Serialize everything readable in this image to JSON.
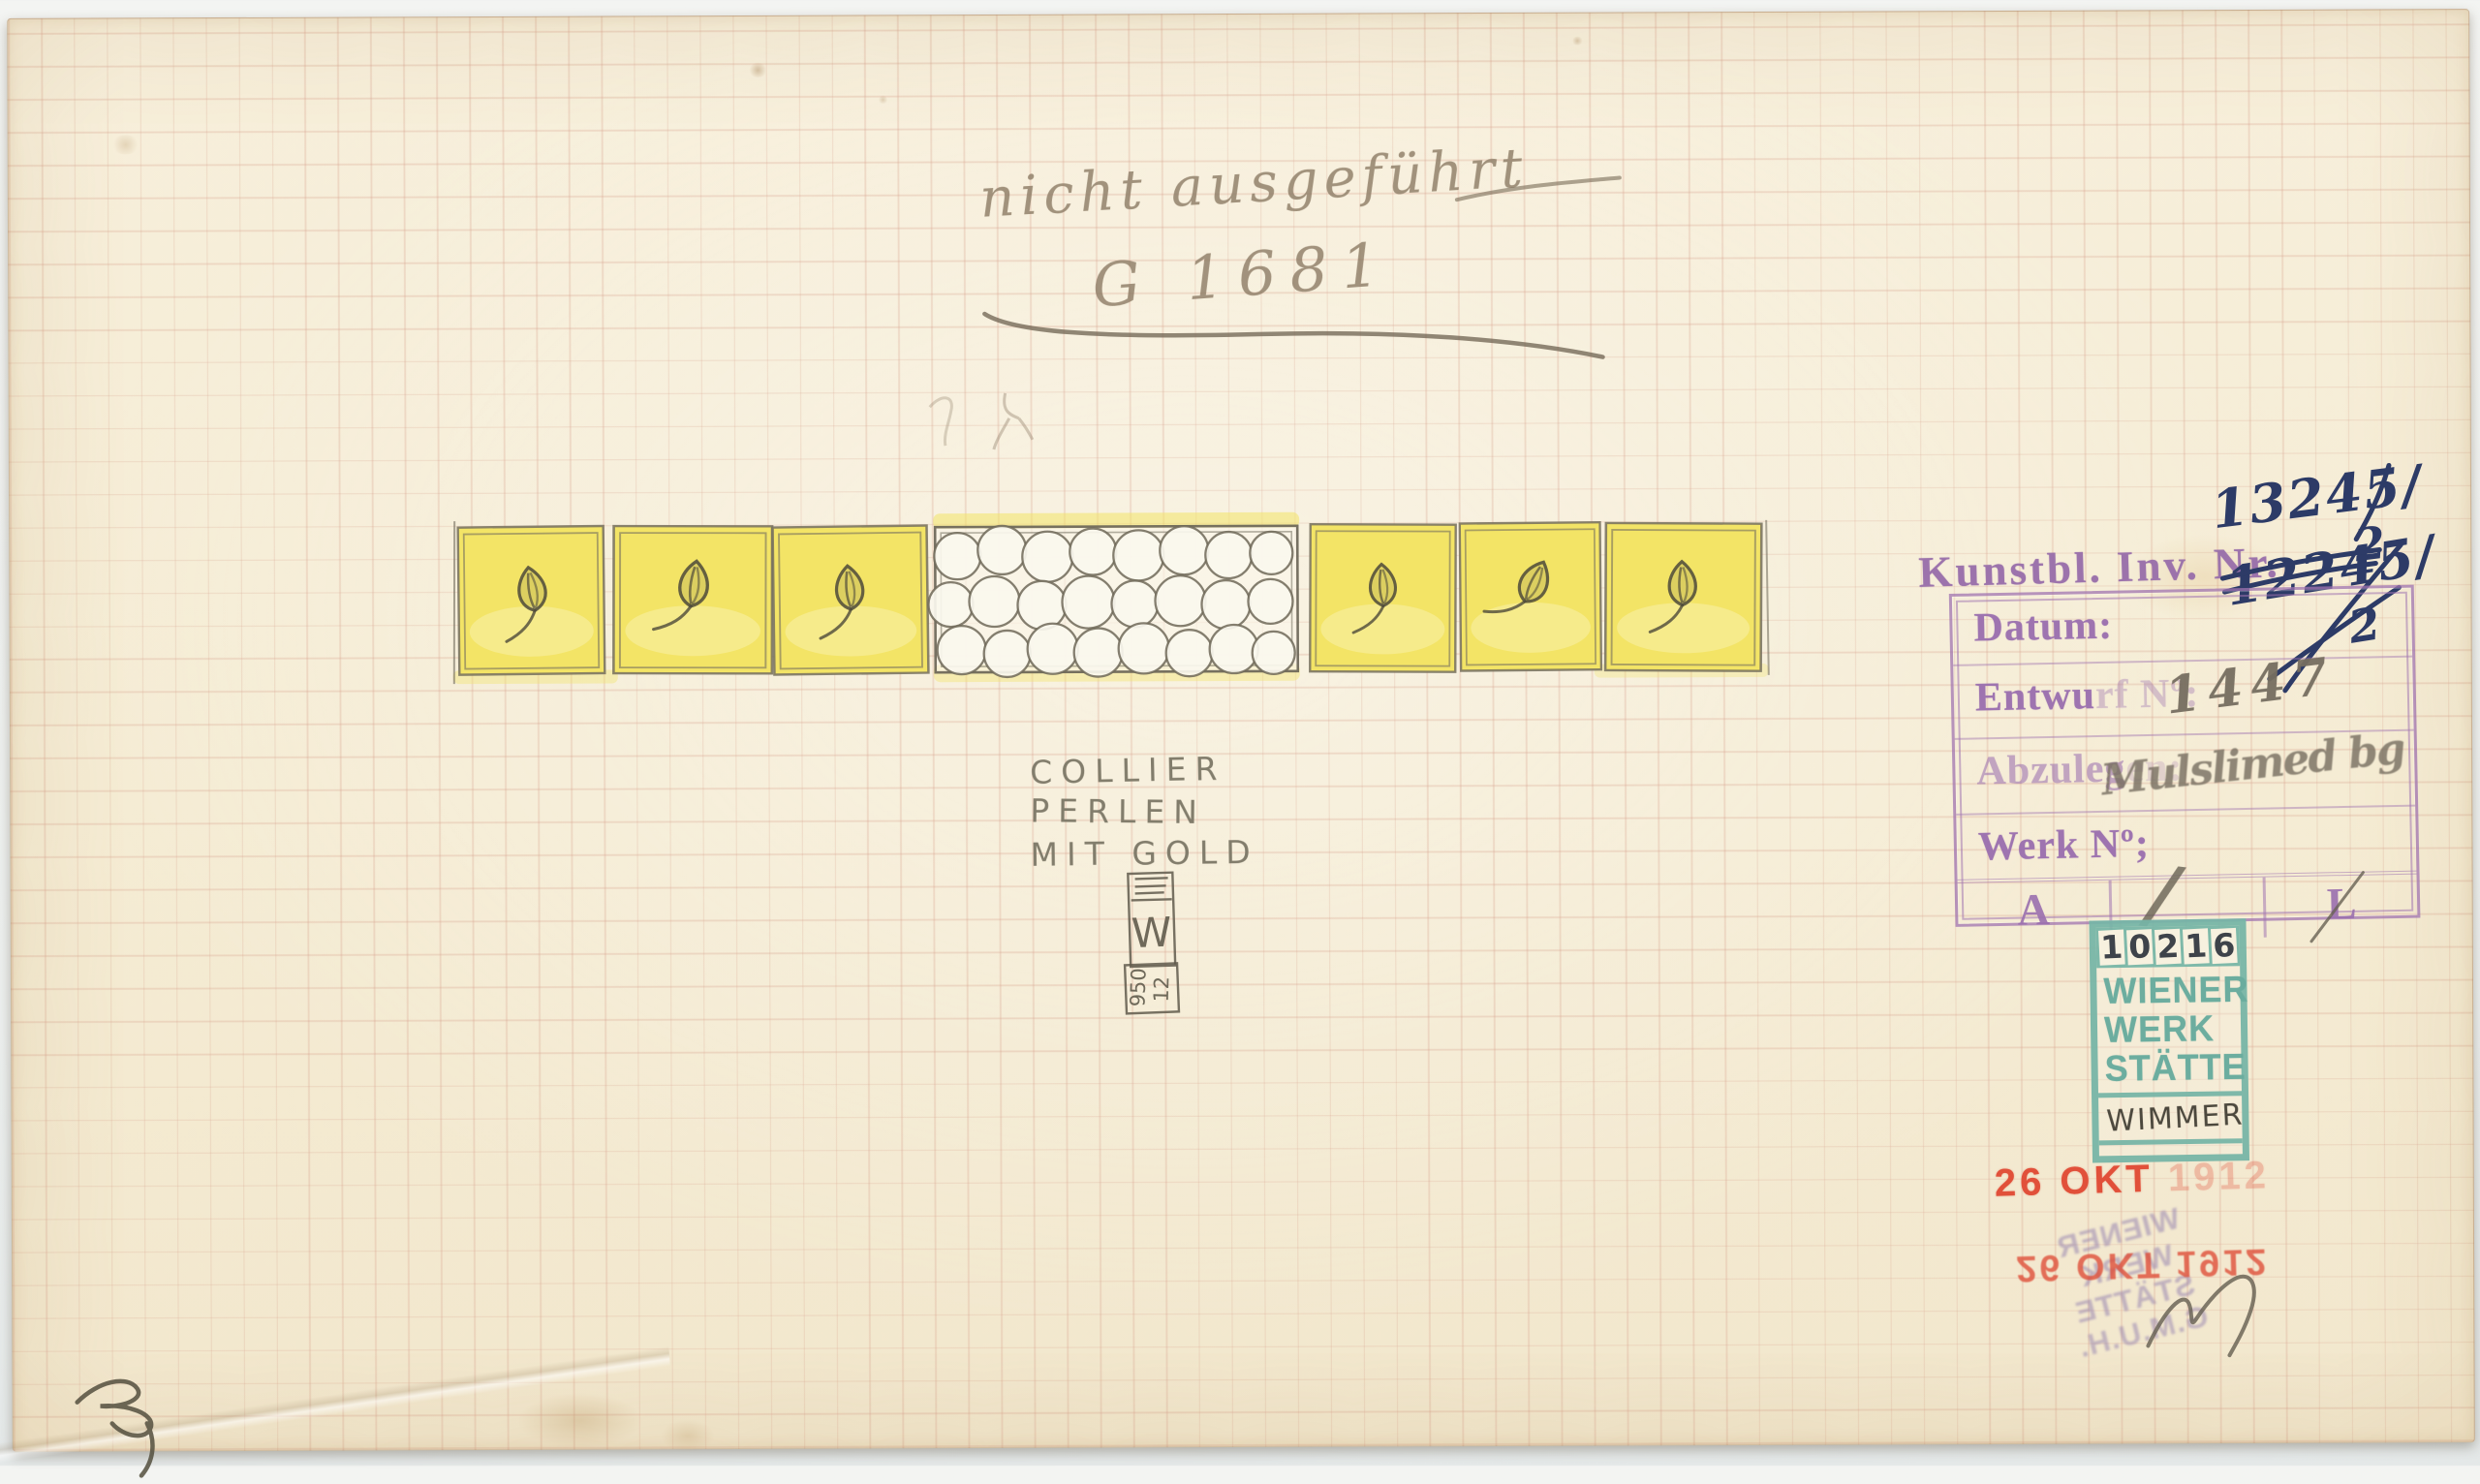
{
  "pencil": {
    "note_top": "nicht ausgeführt",
    "model_no": "G 1681",
    "title_line1": "COLLIER",
    "title_line2": "PERLEN",
    "title_line3": "MIT GOLD",
    "entwurf_value": "1447",
    "abzulegen_value": "Mulslimed bg",
    "grade_slash": "/",
    "wimmer_name": "WIMMER",
    "monogram_top": "E",
    "monogram_mid": "W",
    "monogram_num_left": "950",
    "monogram_num_right": "12"
  },
  "ink": {
    "inventory_new_main": "13245/",
    "inventory_new_den": "2",
    "inventory_old_main": "12245/",
    "inventory_old_den": "2"
  },
  "stamps": {
    "kunstbl_label": "Kunstbl. Inv. Nr.",
    "datum_label": "Datum:",
    "entwurf_label_a": "Entwu",
    "entwurf_label_b": "rf Nº:",
    "abzulegen_label_a": "Abzuleg",
    "abzulegen_label_b": "en:",
    "werk_label": "Werk Nº;",
    "cell_a": "A",
    "cell_l": "L",
    "ww_digits": [
      "1",
      "0",
      "2",
      "1",
      "6"
    ],
    "ww_line1": "WIENER",
    "ww_line2": "WERK",
    "ww_line3": "STÄTTE",
    "date_front": "26 OKT",
    "date_front_faint": "1912",
    "date_back": "26 OKT 1912",
    "ghost_line1": "WIENER",
    "ghost_line2": "WERK",
    "ghost_line3": "STÄTTE",
    "ghost_line4": "G.M.U.H."
  },
  "design": {
    "subject": "necklace band, pearls with gold",
    "left_gold_squares": 3,
    "right_gold_squares": 3,
    "pearl_count": 24,
    "colors": {
      "paper": "#f6eed8",
      "grid_line": "#e0c0ae",
      "gold_wash": "#f3e466",
      "pencil": "#6e6a5b",
      "stamp_purple": "#9d74ad",
      "stamp_teal": "#71b2a4",
      "stamp_red": "#e1503a",
      "ink_blue": "#2d3b67"
    }
  }
}
